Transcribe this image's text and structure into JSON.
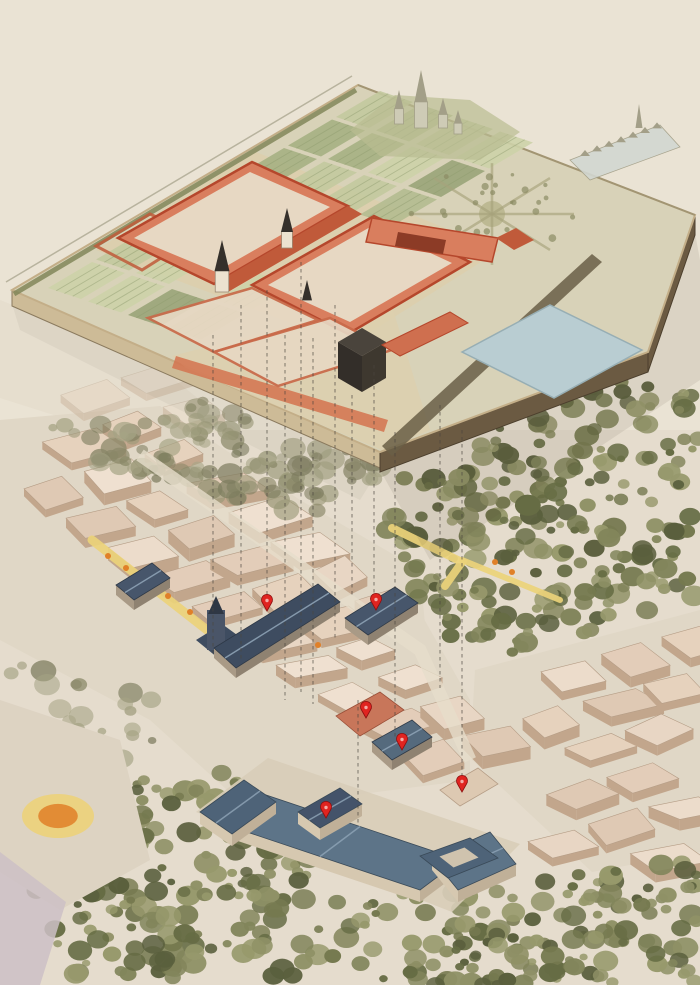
{
  "canvas": {
    "width": 700,
    "height": 985
  },
  "palette": {
    "paper": "#eae3d4",
    "city_wash": "#e0d7c6",
    "block_tops": [
      "#e8d6c4",
      "#ecdccb",
      "#e3cdb9",
      "#efe0d0",
      "#e6d2bd",
      "#dfc9b4"
    ],
    "block_wall": "#c2a68c",
    "block_line": "#b59d86",
    "tree_greens": [
      "#75794f",
      "#666c44",
      "#82855b",
      "#8f9166",
      "#5a5f3d",
      "#97996c"
    ],
    "tree_pale": [
      "#9a9878",
      "#8a8868",
      "#a5a384",
      "#7d7c5e"
    ],
    "platform_top": "#d8d2b8",
    "platform_apron": "#ddcfac",
    "garden_greens": [
      "#b4bb90",
      "#a6b083",
      "#c3c99e",
      "#9aa479",
      "#cdd2a9"
    ],
    "garden_stripe": "#8d9a6d",
    "hedge": "#7d8355",
    "edge_sw": "#cdbb97",
    "edge_se": "#6b5a42",
    "edge_lip": "#c3ae88",
    "edge_line": "#8a7a5e",
    "palace_wall": "#d97e5e",
    "palace_wall_dark": "#c05a3a",
    "palace_roof": "#b5472c",
    "court_fill": "#e7d8c3",
    "spire": "#35302b",
    "tower": "#ece2cf",
    "dark_cube": [
      "#4a443c",
      "#332e29",
      "#3e382f"
    ],
    "pond_fill": "#b9cdd2",
    "pond_edge": "#97aeb4",
    "star_path": "#a7a37c",
    "avenue": "#6a5f46",
    "horizon_fill": "#cecbb6",
    "horizon_line": "#a39f88",
    "hill": "#b9bc92",
    "town_fill": "#d2d7d1",
    "slate": [
      "#3e4c60",
      "#47566b",
      "#556a7d"
    ],
    "slate_ridge": "#8da2b5",
    "prado_roof": "#5d7488",
    "prado_roof_dark": "#4e6378",
    "prado_wall": "#d6c8b0",
    "red_building": "#c8765a",
    "marker": "#e02420",
    "marker_dark": "#8d0f0f",
    "road_yellow": "#ecd27a",
    "dot_orange": "#e08028",
    "dash": "#4a453e",
    "shadow": "#55523f",
    "lavender": "#cdc0c6",
    "plaza": "#ddd3c2"
  },
  "platform": {
    "outline": [
      [
        12,
        290
      ],
      [
        358,
        85
      ],
      [
        695,
        215
      ],
      [
        648,
        352
      ],
      [
        380,
        452
      ]
    ],
    "sw_edge": [
      [
        12,
        290
      ],
      [
        380,
        452
      ]
    ],
    "se_edges": [
      [
        [
          380,
          452
        ],
        [
          648,
          352
        ]
      ],
      [
        [
          648,
          352
        ],
        [
          695,
          215
        ]
      ]
    ],
    "edge_height": 16,
    "back_edge": [
      [
        358,
        85
      ],
      [
        695,
        215
      ]
    ],
    "apron": [
      [
        96,
        250
      ],
      [
        256,
        152
      ],
      [
        500,
        250
      ],
      [
        350,
        345
      ]
    ],
    "apron2": [
      [
        172,
        356
      ],
      [
        390,
        300
      ],
      [
        430,
        430
      ],
      [
        382,
        450
      ],
      [
        186,
        368
      ]
    ],
    "garden": {
      "origin": [
        48,
        288
      ],
      "u": [
        48,
        -28.5
      ],
      "v": [
        40,
        13.5
      ],
      "cols": 9,
      "rows": 4,
      "plot_u": [
        44,
        -26
      ],
      "plot_v": [
        33,
        11
      ]
    },
    "star": {
      "center": [
        492,
        214
      ],
      "radius": 82,
      "spokes": 8
    },
    "avenue_band": [
      [
        382,
        446
      ],
      [
        592,
        254
      ],
      [
        602,
        262
      ],
      [
        392,
        456
      ]
    ],
    "pond": [
      [
        462,
        352
      ],
      [
        550,
        305
      ],
      [
        642,
        350
      ],
      [
        554,
        398
      ]
    ],
    "hill": [
      [
        350,
        130
      ],
      [
        395,
        95
      ],
      [
        470,
        100
      ],
      [
        520,
        132
      ],
      [
        480,
        160
      ],
      [
        380,
        156
      ]
    ],
    "horizon_spires": [
      {
        "x": 421,
        "base": 128,
        "h": 58,
        "w": 13
      },
      {
        "x": 399,
        "base": 124,
        "h": 34,
        "w": 9
      },
      {
        "x": 443,
        "base": 128,
        "h": 30,
        "w": 9
      },
      {
        "x": 458,
        "base": 134,
        "h": 24,
        "w": 8
      }
    ],
    "town": {
      "strip": [
        [
          570,
          160
        ],
        [
          660,
          125
        ],
        [
          680,
          147
        ],
        [
          590,
          180
        ]
      ],
      "spire": {
        "x": 639,
        "base": 128,
        "h": 24,
        "w": 7
      }
    }
  },
  "palace": {
    "court1_outer": [
      [
        118,
        238
      ],
      [
        252,
        162
      ],
      [
        348,
        206
      ],
      [
        214,
        284
      ]
    ],
    "court1_inner": [
      [
        134,
        238
      ],
      [
        250,
        172
      ],
      [
        330,
        207
      ],
      [
        216,
        272
      ]
    ],
    "court2_outer": [
      [
        252,
        285
      ],
      [
        374,
        216
      ],
      [
        470,
        262
      ],
      [
        348,
        334
      ]
    ],
    "court2_inner": [
      [
        268,
        285
      ],
      [
        372,
        226
      ],
      [
        452,
        263
      ],
      [
        350,
        322
      ]
    ],
    "center_wing": [
      [
        214,
        284
      ],
      [
        348,
        206
      ],
      [
        362,
        214
      ],
      [
        228,
        292
      ]
    ],
    "east_wing": [
      [
        372,
        218
      ],
      [
        498,
        238
      ],
      [
        492,
        262
      ],
      [
        366,
        242
      ]
    ],
    "east_wing_dark": [
      [
        398,
        232
      ],
      [
        446,
        240
      ],
      [
        443,
        254
      ],
      [
        395,
        246
      ]
    ],
    "east_pavilion": [
      [
        496,
        238
      ],
      [
        516,
        228
      ],
      [
        534,
        240
      ],
      [
        514,
        250
      ]
    ],
    "west_court": [
      [
        96,
        246
      ],
      [
        150,
        214
      ],
      [
        196,
        236
      ],
      [
        142,
        270
      ]
    ],
    "encl1": [
      [
        148,
        318
      ],
      [
        252,
        288
      ],
      [
        318,
        320
      ],
      [
        214,
        352
      ]
    ],
    "encl2": [
      [
        214,
        352
      ],
      [
        330,
        318
      ],
      [
        392,
        350
      ],
      [
        278,
        386
      ]
    ],
    "colonnade": [
      [
        176,
        356
      ],
      [
        388,
        420
      ],
      [
        384,
        432
      ],
      [
        172,
        368
      ]
    ],
    "cube": {
      "top": [
        [
          338,
          342
        ],
        [
          362,
          328
        ],
        [
          386,
          342
        ],
        [
          362,
          356
        ]
      ],
      "left": [
        [
          338,
          342
        ],
        [
          362,
          356
        ],
        [
          362,
          392
        ],
        [
          338,
          378
        ]
      ],
      "right": [
        [
          362,
          356
        ],
        [
          386,
          342
        ],
        [
          386,
          378
        ],
        [
          362,
          392
        ]
      ]
    },
    "cube_wing": [
      [
        382,
        345
      ],
      [
        450,
        312
      ],
      [
        468,
        323
      ],
      [
        400,
        356
      ]
    ],
    "spires": [
      {
        "x": 222,
        "base": 292,
        "h": 52,
        "w": 15,
        "tower": true
      },
      {
        "x": 287,
        "base": 248,
        "h": 40,
        "w": 12,
        "tower": true
      },
      {
        "x": 307,
        "base": 314,
        "h": 34,
        "w": 10,
        "tower": false
      }
    ]
  },
  "projection_lines": [
    [
      213,
      335,
      213,
      655
    ],
    [
      241,
      305,
      241,
      662
    ],
    [
      267,
      290,
      267,
      598
    ],
    [
      285,
      335,
      285,
      700
    ],
    [
      301,
      262,
      301,
      692
    ],
    [
      313,
      338,
      313,
      704
    ],
    [
      335,
      305,
      335,
      638
    ],
    [
      352,
      395,
      352,
      598
    ],
    [
      374,
      365,
      374,
      597
    ],
    [
      395,
      432,
      395,
      738
    ],
    [
      440,
      405,
      440,
      688
    ],
    [
      462,
      430,
      462,
      778
    ],
    [
      358,
      700,
      358,
      826
    ]
  ],
  "city": {
    "regions": [
      [
        [
          0,
          420
        ],
        [
          160,
          406
        ],
        [
          300,
          500
        ],
        [
          420,
          570
        ],
        [
          432,
          700
        ],
        [
          330,
          800
        ],
        [
          238,
          800
        ],
        [
          150,
          720
        ],
        [
          0,
          640
        ]
      ],
      [
        [
          230,
          660
        ],
        [
          420,
          612
        ],
        [
          470,
          700
        ],
        [
          470,
          780
        ],
        [
          300,
          802
        ]
      ],
      [
        [
          475,
          670
        ],
        [
          700,
          610
        ],
        [
          700,
          852
        ],
        [
          592,
          872
        ],
        [
          470,
          758
        ]
      ]
    ],
    "faint_region": [
      [
        0,
        300
      ],
      [
        150,
        360
      ],
      [
        240,
        432
      ],
      [
        120,
        436
      ],
      [
        0,
        398
      ]
    ],
    "grid": {
      "origin": [
        -60,
        430
      ],
      "u": [
        52,
        -15
      ],
      "v": [
        30,
        21
      ],
      "su": 1.16,
      "sv": 1.4,
      "cols": 15,
      "rows": 25
    }
  },
  "trees": {
    "regions": [
      {
        "poly": [
          [
            40,
            428
          ],
          [
            200,
            400
          ],
          [
            400,
            470
          ],
          [
            300,
            522
          ],
          [
            110,
            470
          ]
        ],
        "count": 120,
        "pale": true
      },
      {
        "poly": [
          [
            380,
            470
          ],
          [
            520,
            420
          ],
          [
            650,
            365
          ],
          [
            700,
            385
          ],
          [
            700,
            600
          ],
          [
            475,
            665
          ],
          [
            380,
            560
          ]
        ],
        "count": 240,
        "pale": false
      },
      {
        "poly": [
          [
            540,
            880
          ],
          [
            700,
            858
          ],
          [
            700,
            985
          ],
          [
            430,
            985
          ],
          [
            432,
            938
          ]
        ],
        "count": 120,
        "pale": false
      },
      {
        "poly": [
          [
            40,
            770
          ],
          [
            240,
            772
          ],
          [
            330,
            832
          ],
          [
            300,
            930
          ],
          [
            140,
            985
          ],
          [
            60,
            985
          ],
          [
            20,
            870
          ]
        ],
        "count": 150,
        "pale": false
      },
      {
        "poly": [
          [
            150,
            860
          ],
          [
            520,
            892
          ],
          [
            545,
            985
          ],
          [
            150,
            985
          ]
        ],
        "count": 80,
        "pale": false
      },
      {
        "poly": [
          [
            0,
            660
          ],
          [
            150,
            680
          ],
          [
            170,
            760
          ],
          [
            20,
            760
          ]
        ],
        "count": 26,
        "pale": true
      }
    ]
  },
  "roads": {
    "plaza": [
      [
        0,
        700
      ],
      [
        120,
        740
      ],
      [
        150,
        860
      ],
      [
        60,
        910
      ],
      [
        0,
        872
      ]
    ],
    "lavender_road": [
      [
        0,
        852
      ],
      [
        66,
        902
      ],
      [
        40,
        985
      ],
      [
        0,
        985
      ]
    ],
    "pale_street": [
      [
        140,
        455
      ],
      [
        420,
        650
      ],
      [
        470,
        760
      ]
    ],
    "yellow_paths": [
      {
        "pts": [
          [
            92,
            540
          ],
          [
            230,
            648
          ]
        ],
        "w": 9
      },
      {
        "pts": [
          [
            392,
            528
          ],
          [
            462,
            562
          ],
          [
            445,
            586
          ]
        ],
        "w": 8
      },
      {
        "pts": [
          [
            462,
            560
          ],
          [
            560,
            600
          ]
        ],
        "w": 6
      }
    ],
    "orange_dots": [
      [
        108,
        556
      ],
      [
        126,
        568
      ],
      [
        147,
        583
      ],
      [
        168,
        596
      ],
      [
        190,
        612
      ],
      [
        212,
        630
      ],
      [
        495,
        562
      ],
      [
        512,
        572
      ],
      [
        318,
        645
      ]
    ],
    "roundabout": {
      "cx": 58,
      "cy": 816,
      "rx": 36,
      "ry": 22
    }
  },
  "landmarks": {
    "church_tower": {
      "body": [
        [
          196,
          640
        ],
        [
          222,
          624
        ],
        [
          244,
          640
        ],
        [
          218,
          658
        ]
      ],
      "tower": [
        207,
        610,
        18,
        40
      ],
      "spike": [
        216,
        596
      ]
    },
    "long_slate": [
      [
        214,
        648
      ],
      [
        318,
        584
      ],
      [
        340,
        602
      ],
      [
        236,
        668
      ]
    ],
    "slate2": [
      [
        345,
        618
      ],
      [
        395,
        587
      ],
      [
        418,
        603
      ],
      [
        368,
        635
      ]
    ],
    "red_block": [
      [
        336,
        716
      ],
      [
        380,
        692
      ],
      [
        404,
        710
      ],
      [
        360,
        736
      ]
    ],
    "slate_small": [
      [
        372,
        742
      ],
      [
        412,
        720
      ],
      [
        432,
        737
      ],
      [
        392,
        760
      ]
    ],
    "tan_tall": [
      [
        440,
        790
      ],
      [
        478,
        768
      ],
      [
        498,
        784
      ],
      [
        460,
        806
      ]
    ],
    "west_dark": [
      [
        116,
        585
      ],
      [
        152,
        563
      ],
      [
        170,
        578
      ],
      [
        134,
        600
      ]
    ],
    "prado": {
      "base": [
        [
          196,
          812
        ],
        [
          268,
          758
        ],
        [
          520,
          844
        ],
        [
          452,
          912
        ]
      ],
      "main": [
        [
          220,
          823
        ],
        [
          260,
          793
        ],
        [
          460,
          860
        ],
        [
          420,
          890
        ]
      ],
      "west_pav": [
        [
          200,
          812
        ],
        [
          244,
          780
        ],
        [
          276,
          802
        ],
        [
          232,
          834
        ]
      ],
      "center_pav": [
        [
          298,
          812
        ],
        [
          340,
          788
        ],
        [
          362,
          804
        ],
        [
          320,
          828
        ]
      ],
      "east_pav": [
        [
          432,
          858
        ],
        [
          490,
          832
        ],
        [
          516,
          864
        ],
        [
          458,
          890
        ]
      ],
      "ring": [
        [
          420,
          856
        ],
        [
          470,
          838
        ],
        [
          498,
          858
        ],
        [
          448,
          878
        ]
      ],
      "wall_h": 12
    }
  },
  "markers": [
    {
      "x": 267,
      "y": 607
    },
    {
      "x": 376,
      "y": 606
    },
    {
      "x": 366,
      "y": 714
    },
    {
      "x": 402,
      "y": 746
    },
    {
      "x": 462,
      "y": 788
    },
    {
      "x": 326,
      "y": 814
    }
  ]
}
